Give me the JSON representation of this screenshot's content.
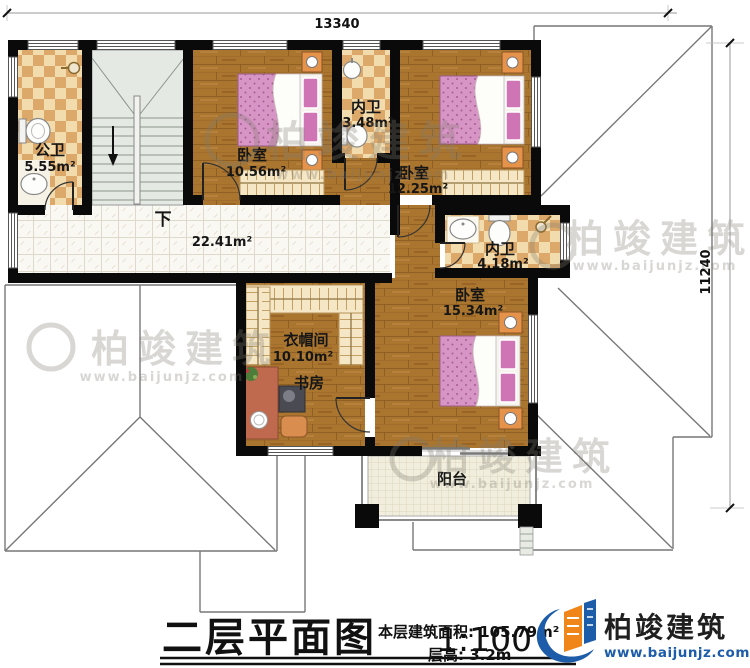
{
  "plan": {
    "title": "二层平面图",
    "scale": "1:100",
    "area_note": "本层建筑面积: 105.79m²",
    "height_note": "层高: 3.2m"
  },
  "dimensions": {
    "width_mm": "13340",
    "height_mm": "11240"
  },
  "rooms": {
    "public_bath": {
      "name": "公卫",
      "area": "5.55m²"
    },
    "bedroom1": {
      "name": "卧室",
      "area": "10.56m²"
    },
    "bath1": {
      "name": "内卫",
      "area": "3.48m²"
    },
    "bedroom2": {
      "name": "卧室",
      "area": "12.25m²"
    },
    "hallway": {
      "area": "22.41m²"
    },
    "bath2": {
      "name": "内卫",
      "area": "4.18m²"
    },
    "bedroom3": {
      "name": "卧室",
      "area": "15.34m²"
    },
    "cloakroom": {
      "name": "衣帽间",
      "area": "10.10m²"
    },
    "study": {
      "name": "书房"
    },
    "balcony": {
      "name": "阳台"
    }
  },
  "stairs": {
    "down_label": "下"
  },
  "watermark": {
    "brand": "柏竣建筑",
    "website": "www.baijunjz.com"
  },
  "logo": {
    "brand": "柏竣建筑",
    "website": "www.baijunjz.com"
  },
  "colors": {
    "wall": "#0a0a0a",
    "wood_floor": "#a9752f",
    "tile_tan": "#dca96b",
    "tile_cream": "#f2dcae",
    "brand_blue": "#1c5ca8",
    "brand_orange": "#f08519",
    "bed_pink": "#d795c5"
  }
}
